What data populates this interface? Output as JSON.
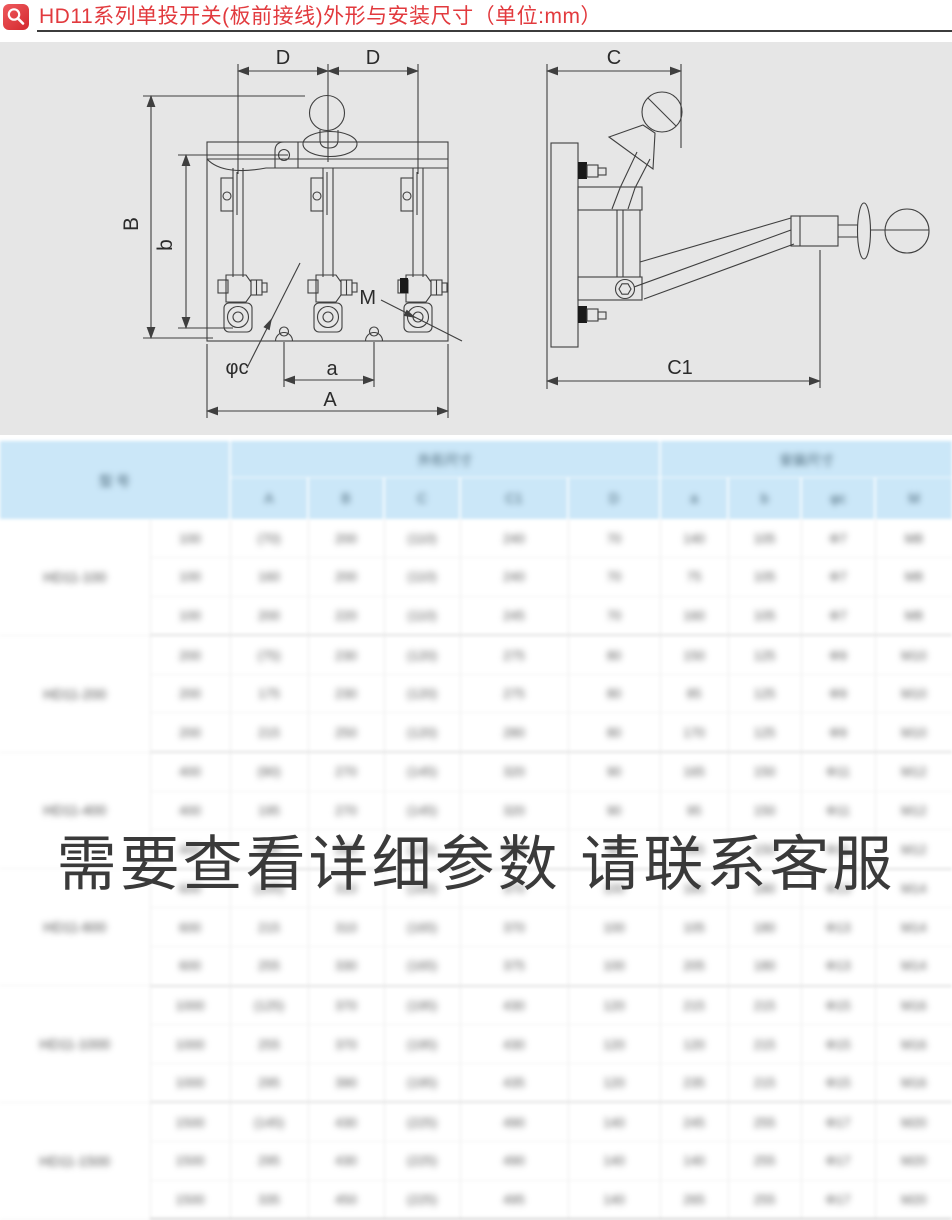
{
  "header": {
    "title": "HD11系列单投开关(板前接线)外形与安装尺寸（单位:mm）"
  },
  "diagram": {
    "front": {
      "dim_d_left": "D",
      "dim_d_right": "D",
      "dim_B": "B",
      "dim_b": "b",
      "label_M": "M",
      "label_phi_c": "φc",
      "dim_a": "a",
      "dim_A": "A"
    },
    "side": {
      "dim_C": "C",
      "dim_C1": "C1"
    }
  },
  "watermark": "需要查看详细参数 请联系客服",
  "table": {
    "model_header": "型 号",
    "group_outline": "外形尺寸",
    "group_install": "安装尺寸",
    "dim_headers": [
      "A",
      "B",
      "C",
      "C1",
      "D",
      "a",
      "b",
      "φc",
      "M"
    ],
    "groups": [
      {
        "model": "HD11-100",
        "rows": [
          [
            "100",
            "(70)",
            "200",
            "(110)",
            "240",
            "70",
            "140",
            "105",
            "Φ7",
            "M8"
          ],
          [
            "100",
            "160",
            "200",
            "(110)",
            "240",
            "70",
            "75",
            "105",
            "Φ7",
            "M8"
          ],
          [
            "100",
            "200",
            "220",
            "(110)",
            "245",
            "70",
            "160",
            "105",
            "Φ7",
            "M8"
          ]
        ]
      },
      {
        "model": "HD11-200",
        "rows": [
          [
            "200",
            "(75)",
            "230",
            "(120)",
            "275",
            "80",
            "150",
            "125",
            "Φ9",
            "M10"
          ],
          [
            "200",
            "175",
            "230",
            "(120)",
            "275",
            "80",
            "85",
            "125",
            "Φ9",
            "M10"
          ],
          [
            "200",
            "215",
            "250",
            "(120)",
            "280",
            "80",
            "170",
            "125",
            "Φ9",
            "M10"
          ]
        ]
      },
      {
        "model": "HD11-400",
        "rows": [
          [
            "400",
            "(90)",
            "270",
            "(145)",
            "320",
            "90",
            "165",
            "150",
            "Φ11",
            "M12"
          ],
          [
            "400",
            "195",
            "270",
            "(145)",
            "320",
            "90",
            "95",
            "150",
            "Φ11",
            "M12"
          ],
          [
            "400",
            "235",
            "290",
            "(145)",
            "325",
            "90",
            "185",
            "150",
            "Φ11",
            "M12"
          ]
        ]
      },
      {
        "model": "HD11-600",
        "rows": [
          [
            "600",
            "(105)",
            "310",
            "(165)",
            "370",
            "100",
            "185",
            "180",
            "Φ13",
            "M14"
          ],
          [
            "600",
            "215",
            "310",
            "(165)",
            "370",
            "100",
            "105",
            "180",
            "Φ13",
            "M14"
          ],
          [
            "600",
            "255",
            "330",
            "(165)",
            "375",
            "100",
            "205",
            "180",
            "Φ13",
            "M14"
          ]
        ]
      },
      {
        "model": "HD11-1000",
        "rows": [
          [
            "1000",
            "(125)",
            "370",
            "(195)",
            "430",
            "120",
            "215",
            "215",
            "Φ15",
            "M16"
          ],
          [
            "1000",
            "255",
            "370",
            "(195)",
            "430",
            "120",
            "120",
            "215",
            "Φ15",
            "M16"
          ],
          [
            "1000",
            "295",
            "390",
            "(195)",
            "435",
            "120",
            "235",
            "215",
            "Φ15",
            "M16"
          ]
        ]
      },
      {
        "model": "HD11-1500",
        "rows": [
          [
            "1500",
            "(145)",
            "430",
            "(225)",
            "490",
            "140",
            "245",
            "255",
            "Φ17",
            "M20"
          ],
          [
            "1500",
            "295",
            "430",
            "(225)",
            "490",
            "140",
            "140",
            "255",
            "Φ17",
            "M20"
          ],
          [
            "1500",
            "335",
            "450",
            "(225)",
            "495",
            "140",
            "265",
            "255",
            "Φ17",
            "M20"
          ]
        ]
      }
    ]
  },
  "colors": {
    "title_red": "#e23a3e",
    "table_header_blue": "#cbe7f8",
    "panel_gray": "#e6e6e6",
    "watermark_gray": "#3a3a3a"
  }
}
